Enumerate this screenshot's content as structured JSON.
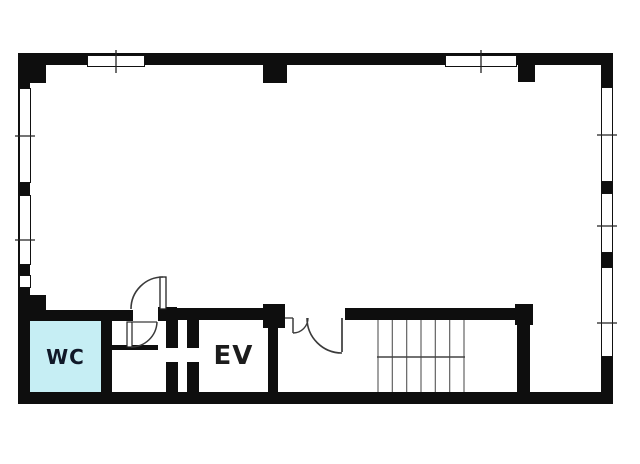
{
  "floorplan": {
    "type": "building-floor-plan",
    "rooms": {
      "wc": {
        "label": "WC",
        "fill": "#c6eef4"
      },
      "elevator": {
        "label": "EV"
      },
      "stairs": {
        "treads": 7
      },
      "main_room": {
        "label": ""
      }
    },
    "colors": {
      "wall": "#0e0e0e",
      "line": "#3a3a3a",
      "background": "#ffffff",
      "wc_fill": "#c6eef4",
      "label_text": "#101828"
    }
  }
}
